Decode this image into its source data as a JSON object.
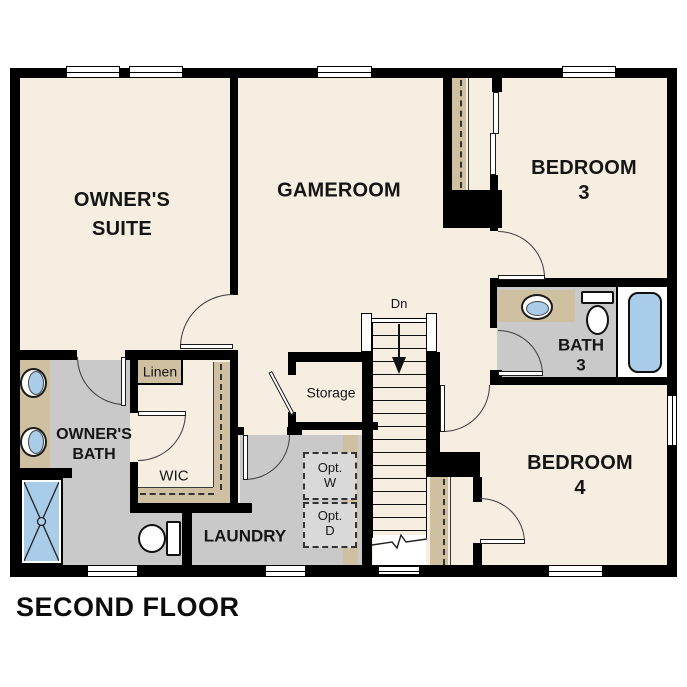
{
  "title": "SECOND FLOOR",
  "colors": {
    "cream": "#f6eee1",
    "tan": "#cfc0a2",
    "gray": "#c9c9c9",
    "optgray": "#d9d9d9",
    "blue": "#a9cce9",
    "wall": "#000000",
    "ink": "#151515"
  },
  "rooms": {
    "owners_suite": "OWNER'S\nSUITE",
    "gameroom": "GAMEROOM",
    "bedroom3": "BEDROOM 3",
    "bedroom4": "BEDROOM 4",
    "bath3": "BATH\n3",
    "owners_bath": "OWNER'S\nBATH",
    "laundry": "LAUNDRY",
    "wic": "WIC",
    "linen": "Linen",
    "storage": "Storage"
  },
  "annotations": {
    "stairs_down": "Dn",
    "opt_washer": "Opt.\nW",
    "opt_dryer": "Opt.\nD"
  },
  "fixtures": [
    "double-vanity-sinks",
    "walk-in-shower",
    "toilet-owners-bath",
    "vanity-sink-bath3",
    "toilet-bath3",
    "bathtub-bath3",
    "staircase-down",
    "bypass-closet-doors-bedroom3"
  ]
}
